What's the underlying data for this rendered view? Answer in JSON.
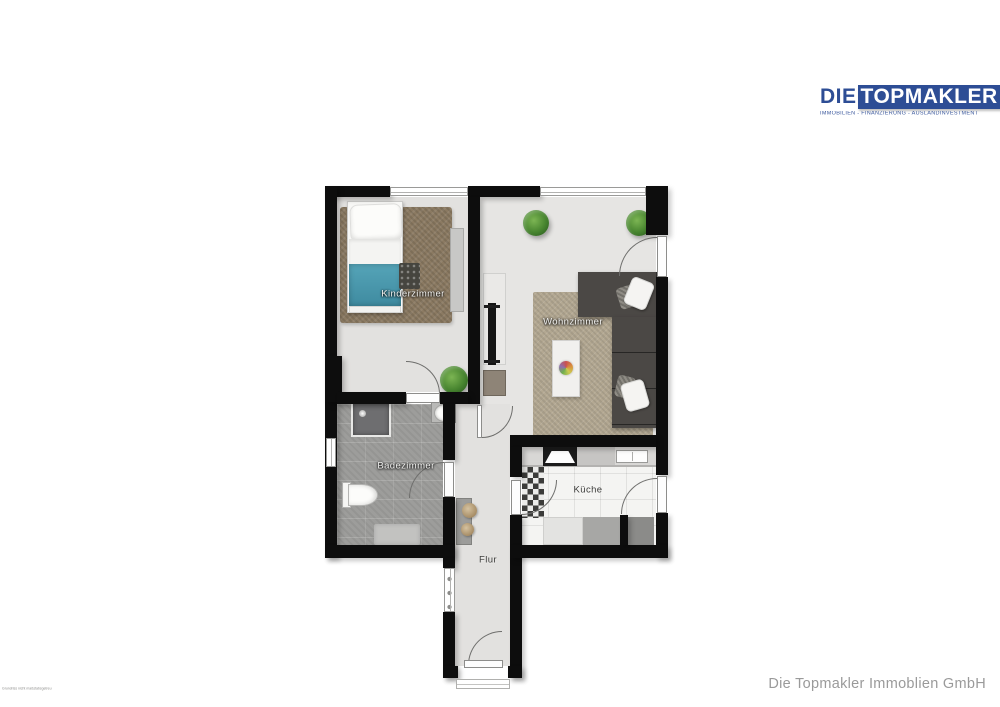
{
  "brand": {
    "prefix": "DIE",
    "name": "TOPMAKLER",
    "tagline": "IMMOBILIEN - FINANZIERUNG - AUSLANDINVESTMENT",
    "blue": "#2d4d95"
  },
  "plan": {
    "rooms": {
      "kinderzimmer": "Kinderzimmer",
      "wohnzimmer": "Wohnzimmer",
      "badezimmer": "Badezimmer",
      "kueche": "Küche",
      "flur": "Flur"
    }
  },
  "footer": {
    "company": "Die Topmakler Immoblien GmbH"
  },
  "fine_print": "Grundriss nicht maßstabsgetreu",
  "palette": {
    "wall": "#0d0d0d",
    "floor_light": "#e4e3e1",
    "bath_tile": "#9d9d9b",
    "kitchen_floor": "#f4f4f2",
    "rug_brown": "#8b7a62",
    "rug_beige": "#b3a892",
    "sofa_gray": "#4b4845",
    "bed_blanket": "#4f9db2",
    "plant_green": "#47842f",
    "brand_blue": "#2d4d95",
    "footer_gray": "#9a9a9a"
  }
}
